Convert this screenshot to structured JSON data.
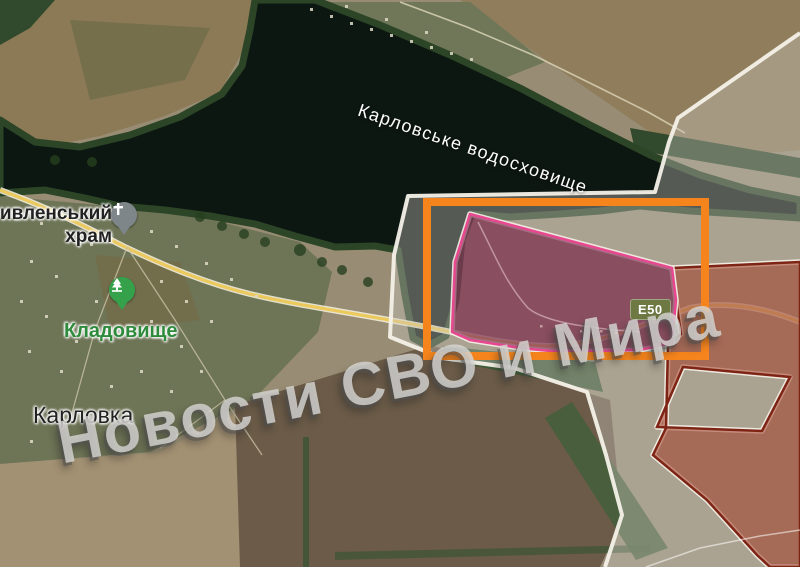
{
  "map": {
    "labels": {
      "reservoir": "Карловське водосховище",
      "church_line1": "ивленський",
      "church_line2": "храм",
      "cemetery": "Кладовище",
      "town": "Карловка"
    },
    "road_badge": "E50",
    "watermark": "Новости СВО и Мира",
    "icons": [
      "church-cross-icon",
      "cemetery-tree-icon"
    ]
  },
  "colors": {
    "orange": "#f5841d",
    "maroon_fill": "rgba(112,18,60,0.58)",
    "maroon_border": "#e8488f",
    "red_fill": "rgba(163,62,40,0.55)",
    "red_border": "#7d2414",
    "frontline": "#f4f1e8",
    "road": "#ecc95d",
    "badge_bg": "#6d7842",
    "cemetery_green": "#2f8b3c",
    "water": "#0d1712"
  }
}
